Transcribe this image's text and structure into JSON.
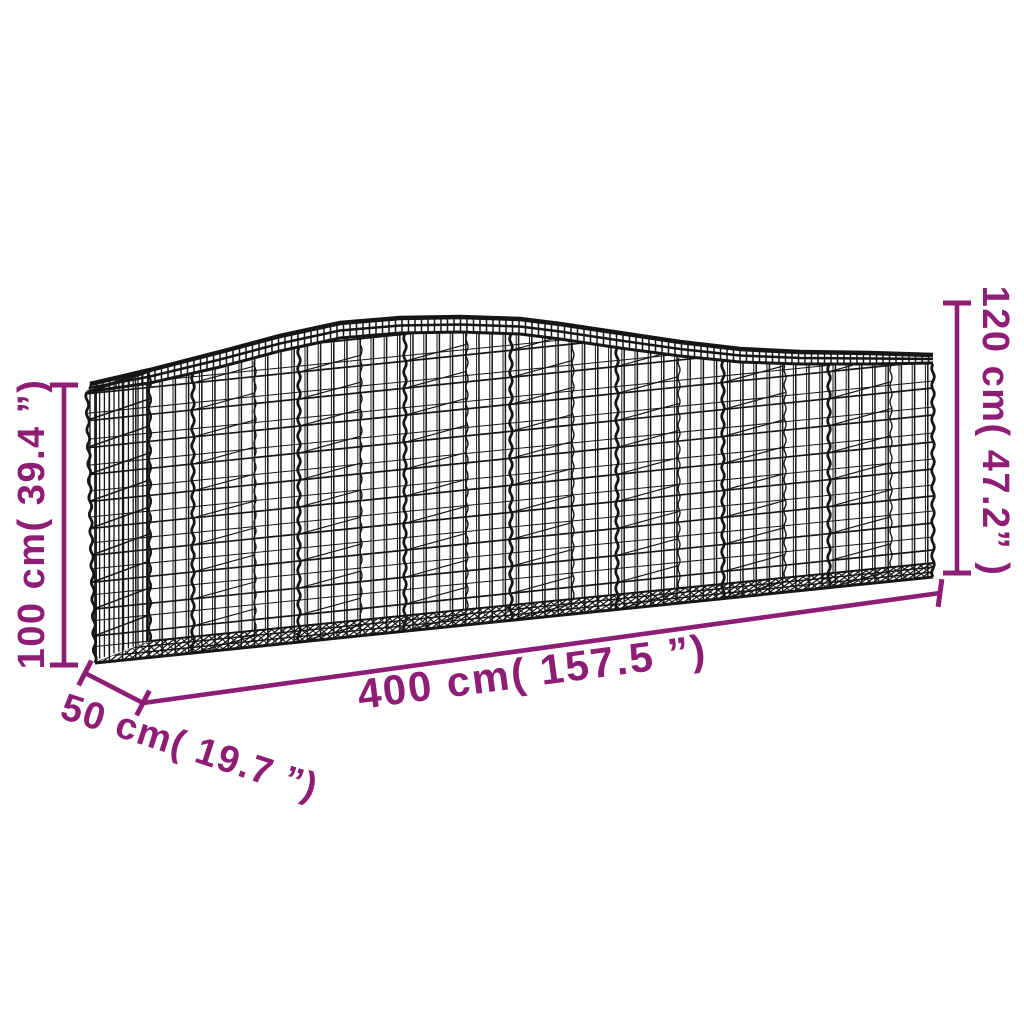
{
  "diagram": {
    "type": "product-dimension-diagram",
    "subject": "arched-gabion-wire-mesh-basket",
    "colors": {
      "annotation": "#8d1d75",
      "wire": "#161616",
      "background": "#ffffff"
    },
    "dimensions": {
      "height_front": {
        "cm": "100 cm",
        "inches": "39.4 ”",
        "label": "100 cm( 39.4 ”)"
      },
      "height_back": {
        "cm": "120 cm",
        "inches": "47.2”",
        "label": "120 cm( 47.2” )"
      },
      "length": {
        "cm": "400 cm",
        "inches": "157.5 ”",
        "label": "400 cm( 157.5 ”)"
      },
      "depth": {
        "cm": "50 cm",
        "inches": "19.7 ”",
        "label": "50 cm( 19.7 ”)"
      }
    }
  }
}
